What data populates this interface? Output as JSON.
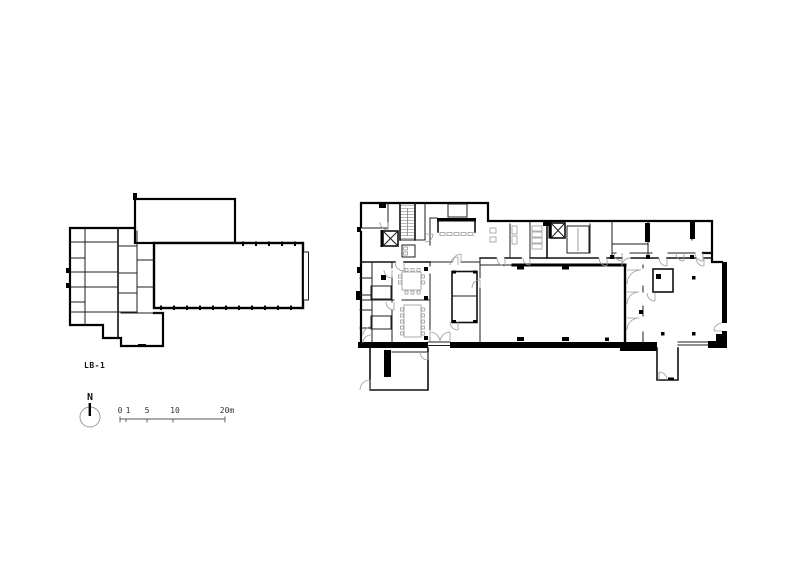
{
  "sheet": {
    "background": "#ffffff",
    "line_color": "#000000",
    "detail_line_color": "#9a9a9a"
  },
  "plans": {
    "basement": {
      "label": "LB-1"
    }
  },
  "north_arrow": {
    "label": "N"
  },
  "scale_bar": {
    "labels": [
      "0",
      "1",
      "5",
      "10",
      "20m"
    ],
    "tick_values": [
      0,
      1,
      5,
      10,
      20
    ],
    "unit": "m"
  }
}
